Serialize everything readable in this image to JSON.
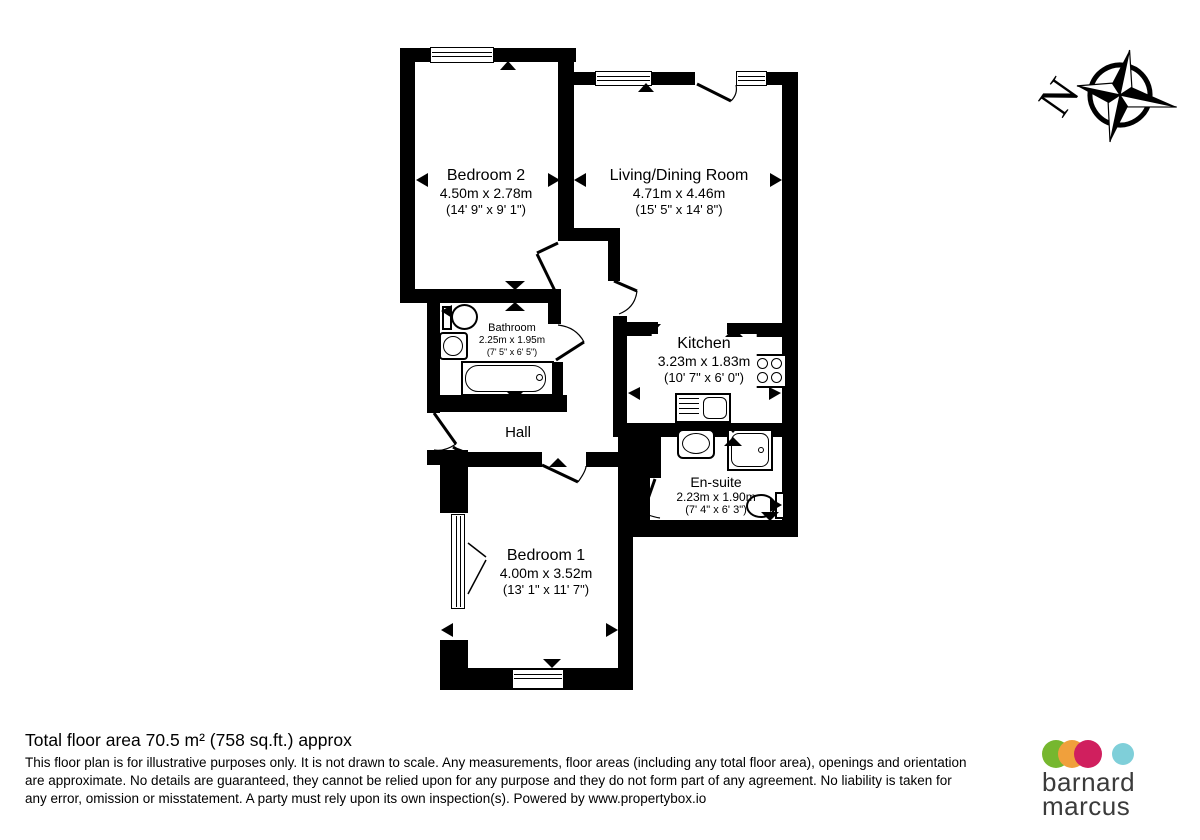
{
  "plan": {
    "compass_label": "N",
    "rooms": [
      {
        "name": "Bedroom 2",
        "metric": "4.50m x 2.78m",
        "imperial": "(14' 9\" x 9' 1\")"
      },
      {
        "name": "Living/Dining Room",
        "metric": "4.71m x 4.46m",
        "imperial": "(15' 5\" x 14' 8\")"
      },
      {
        "name": "Bathroom",
        "metric": "2.25m x 1.95m",
        "imperial": "(7' 5\" x 6' 5\")"
      },
      {
        "name": "Kitchen",
        "metric": "3.23m x 1.83m",
        "imperial": "(10' 7\" x 6' 0\")"
      },
      {
        "name": "Hall"
      },
      {
        "name": "En-suite",
        "metric": "2.23m x 1.90m",
        "imperial": "(7' 4\" x 6' 3\")"
      },
      {
        "name": "Bedroom 1",
        "metric": "4.00m x 3.52m",
        "imperial": "(13' 1\" x 11' 7\")"
      }
    ]
  },
  "footer": {
    "total_area": "Total floor area 70.5 m² (758 sq.ft.) approx",
    "disclaimer": "This floor plan is for illustrative purposes only. It is not drawn to scale. Any measurements, floor areas (including any total floor area), openings and orientation are approximate. No details are guaranteed, they cannot be relied upon for any purpose and they do not form part of any agreement. No liability is taken for any error, omission or misstatement. A party must rely upon its own inspection(s). Powered by www.propertybox.io"
  },
  "logo": {
    "line1": "barnard",
    "line2": "marcus",
    "colors": {
      "green": "#76b72f",
      "orange": "#f0a03c",
      "crimson": "#d01f5e",
      "teal": "#7fcfd9",
      "text": "#3b3b3b"
    }
  }
}
